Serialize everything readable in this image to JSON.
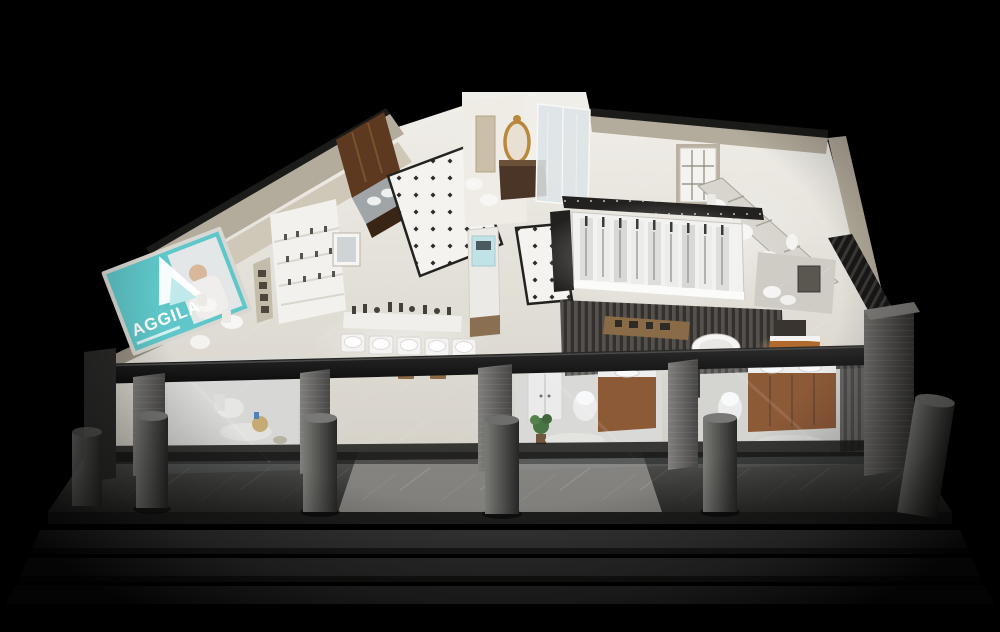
{
  "scene": {
    "type": "3d-render",
    "subject": "Aerial cutaway 3D rendering of a bathroom sanitaryware showroom at night",
    "background_color": "#000000"
  },
  "signage": {
    "brand": "AGGILA",
    "panel_color": "#5fc7c9",
    "text_color": "#ffffff"
  },
  "palette": {
    "wall_beige": "#b3ab9b",
    "wall_inner": "#cfc8b9",
    "wall_cap_dark": "#1b1b19",
    "floor_light": "#e9e6e0",
    "tile_white": "#f4f3f0",
    "tile_dot_dark": "#2a2a28",
    "wood_cabinet": "#5d3a1f",
    "wood_vanity": "#8a4f28",
    "wood_vanity_warm": "#b06a2e",
    "fixture_white": "#f7f6f4",
    "glass_blue": "#dde4e6",
    "gold_frame": "#b8893c",
    "slat_gray": "#4a4744",
    "slat_dark": "#2d2b29",
    "pillar_gray": "#6e6d6b",
    "bollard_gray": "#5a5a58",
    "walkway_gray": "#3f3f3d",
    "step_gray_1": "#343434",
    "step_gray_2": "#2d2d2d",
    "step_gray_3": "#272727",
    "beam_black": "#141414"
  },
  "areas": {
    "left_wing": "brand sign, toilet displays, faucet shelf wall",
    "top_left_wing": "wood kitchen-style vanity cabinets with sinks",
    "back_center": "luxury suite with gold mirror and glass shower",
    "top_right_wing": "white paneled door, marble panels with toilets",
    "center_right": "illuminated shower column display wall",
    "center": "basin and faucet display tables",
    "middle": "wood slat partitions, bathtub, shelf displays",
    "front": "glass storefront with three bathroom vignette rooms",
    "exterior": "gray walkway with round bollards and three steps"
  }
}
